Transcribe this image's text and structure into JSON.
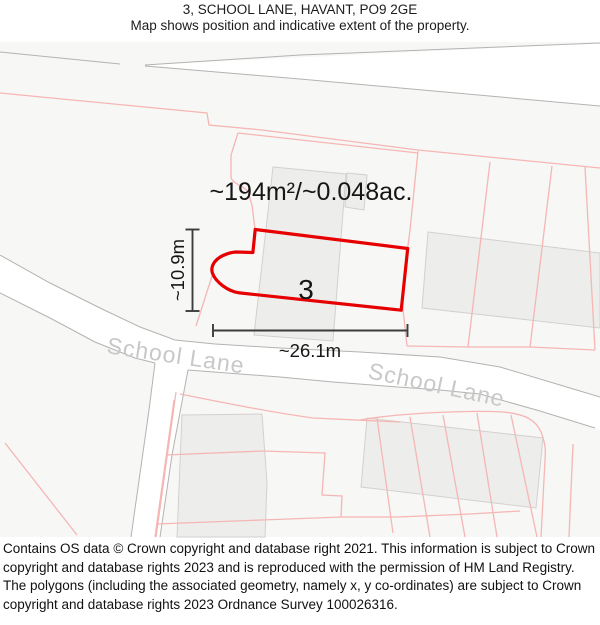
{
  "header": {
    "title": "3, SCHOOL LANE, HAVANT, PO9 2GE",
    "subtitle": "Map shows position and indicative extent of the property."
  },
  "map": {
    "area_label": "~194m²/~0.048ac.",
    "plot_number": "3",
    "width_label": "~26.1m",
    "height_label": "~10.9m",
    "street_labels": [
      "School Lane",
      "School Lane"
    ],
    "colors": {
      "outline": "#e60000",
      "parcel": "#f5b6b4",
      "building_fill": "#ededeb",
      "building_stroke": "#d3d1cf",
      "road_stroke": "#b5b3b1",
      "street_text": "#c8c8c8",
      "dimension": "#3c3c3c"
    }
  },
  "footer": {
    "text": "Contains OS data © Crown copyright and database right 2021. This information is subject to Crown copyright and database rights 2023 and is reproduced with the permission of HM Land Registry. The polygons (including the associated geometry, namely x, y co-ordinates) are subject to Crown copyright and database rights 2023 Ordnance Survey 100026316."
  }
}
